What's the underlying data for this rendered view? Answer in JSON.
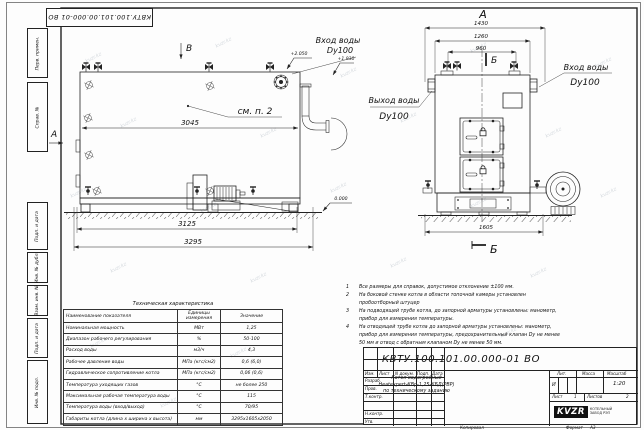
{
  "stamp": {
    "doc_number": "КВТУ.100.101.00.000-01 ВО"
  },
  "frame_labels": [
    "Перв. примен.",
    "Справ. №",
    "Подп. и дата",
    "Инв. № дубл.",
    "Взам. инв. №",
    "Подп. и дата",
    "Инв. № подл."
  ],
  "drawing": {
    "side": {
      "view_b": "В",
      "view_a": "А",
      "see_note": "см. п. 2",
      "dim_3045": "3045",
      "dim_3125": "3125",
      "dim_3295": "3295",
      "elev_top": "+2.050",
      "elev_mid": "+1.930",
      "elev_zero": "0.000",
      "inlet_label": "Вход воды",
      "inlet_dn": "Dy100"
    },
    "front": {
      "view_a": "А",
      "section_b_top": "Б",
      "section_b_bottom": "Б",
      "dim_1430": "1430",
      "dim_1260": "1260",
      "dim_960": "960",
      "dim_1605": "1605",
      "outlet_label": "Выход воды",
      "outlet_dn": "Dy100",
      "inlet_label": "Вход воды",
      "inlet_dn": "Dy100"
    }
  },
  "notes": [
    {
      "num": "1",
      "text": "Все размеры для справок, допустимое отклонение ±100 мм."
    },
    {
      "num": "2",
      "text": "На боковой стенке котла в области топочной камеры установлен пробоотборный штуцер"
    },
    {
      "num": "3",
      "text": "На подводящей трубе котла, до запорной арматуры установлены: манометр, прибор для измерения температуры."
    },
    {
      "num": "4",
      "text": "На отводящей трубе котла до запорной арматуры установлены: манометр, прибор для измерения температуры, предохранительный клапан Dу не менее 50 мм и отвод с обратным клапаном Dу не менее 50 мм."
    }
  ],
  "tech": {
    "title": "Техническая характеристика",
    "col_name": "Наименование показателя",
    "col_units": "Единицы измерения",
    "col_value": "Значение",
    "rows": [
      [
        "Номинальная мощность",
        "МВт",
        "1,25"
      ],
      [
        "Диапазон рабочего регулирования",
        "%",
        "50-100"
      ],
      [
        "Расход воды",
        "м3/ч",
        "4,3"
      ],
      [
        "Рабочее давление воды",
        "МПа (кгс/см2)",
        "0,6 (6,0)"
      ],
      [
        "Гидравлическое сопротивление котла",
        "МПа (кгс/см2)",
        "0,06 (0,6)"
      ],
      [
        "Температура уходящих газов",
        "°С",
        "не более 250"
      ],
      [
        "Максимальная рабочая температура воды",
        "°С",
        "115"
      ],
      [
        "Температура воды (вход/выход)",
        "°С",
        "70/95"
      ],
      [
        "Габариты котла (длина х ширина х высота)",
        "мм",
        "3295х1605х2050"
      ]
    ]
  },
  "titleblock": {
    "doc_number": "КВТУ.100.101.00.000-01 ВО",
    "name_line1": "Котел водогрейный",
    "name_line2": "Heatexpert-КВр-1,25-КБД(РВР)",
    "name_line3": "по техническому заданию",
    "col_izm": "Изм.",
    "col_list": "Лист",
    "col_ndoc": "N докум.",
    "col_podp": "Подп.",
    "col_data": "Дата",
    "row_razrab": "Разраб.",
    "row_prov": "Пров.",
    "row_tkontr": "Т.контр.",
    "row_nkontr": "Н.контр.",
    "row_utv": "Утв.",
    "lit_label": "Лит.",
    "mass_label": "Масса",
    "scale_label": "Масштаб",
    "lit_value": "И",
    "scale_value": "1:20",
    "sheet_label": "Лист",
    "sheet_value": "1",
    "sheets_label": "Листов",
    "sheets_value": "2",
    "logo": "KVZR",
    "logo_line1": "КОТЕЛЬНЫЙ",
    "logo_line2": "ЗАВОД РЭП",
    "kopiroval": "Копировал",
    "format_label": "Формат",
    "format_value": "А3"
  },
  "watermark": "kvzr.kz"
}
